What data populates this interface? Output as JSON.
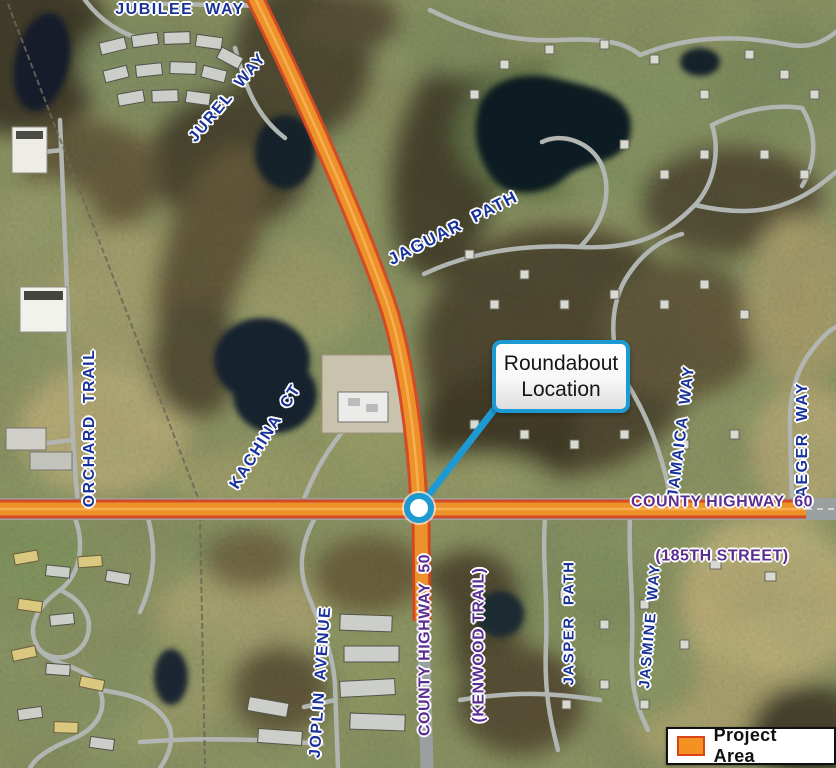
{
  "map": {
    "road_labels": [
      {
        "id": "jubilee-way",
        "text": "JUBILEE  WAY"
      },
      {
        "id": "jurel-way",
        "text": "JUREL  WAY"
      },
      {
        "id": "jaguar-path",
        "text": "JAGUAR  PATH"
      },
      {
        "id": "orchard-trail",
        "text": "ORCHARD  TRAIL"
      },
      {
        "id": "kachina-ct",
        "text": "KACHINA  CT"
      },
      {
        "id": "jamaica-way",
        "text": "JAMAICA  WAY"
      },
      {
        "id": "jaeger-way",
        "text": "JAEGER  WAY"
      },
      {
        "id": "joplin-avenue",
        "text": "JOPLIN  AVENUE"
      },
      {
        "id": "jasper-path",
        "text": "JASPER  PATH"
      },
      {
        "id": "jasmine-way",
        "text": "JASMINE  WAY"
      }
    ],
    "highway_labels": [
      {
        "id": "county-highway-60",
        "line1": "COUNTY HIGHWAY  60",
        "line2": "(185TH STREET)"
      },
      {
        "id": "county-highway-50",
        "line1": "COUNTY HIGHWAY  50",
        "line2": "(KENWOOD TRAIL)"
      }
    ],
    "callout": {
      "text": "Roundabout Location"
    },
    "legend": {
      "label": "Project Area",
      "swatch_color": "#f59120",
      "swatch_border": "#d9441d"
    },
    "colors": {
      "label_navy": "#1a339b",
      "label_purple": "#5a2d91",
      "callout_blue": "#1e9ad2",
      "project_orange": "#f59120",
      "project_edge": "#d9441d"
    }
  }
}
